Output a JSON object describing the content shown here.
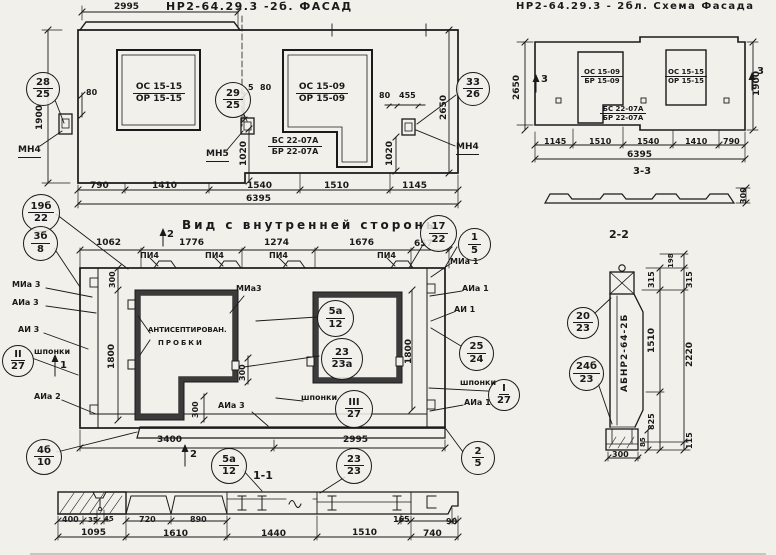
{
  "colors": {
    "paper": "#f2f0ea",
    "ink": "#1a1a1a"
  },
  "facade": {
    "title": "НР2-64.29.3 -2б. ФАСАД",
    "d2995": "2995",
    "win1": {
      "top": "ОС 15-15",
      "bot": "ОР 15-15"
    },
    "win2": {
      "top": "ОС 15-09",
      "bot": "ОР 15-09"
    },
    "sill": {
      "top": "БС 22-07А",
      "bot": "БР 22-07А"
    },
    "d80a": "80",
    "d5": "5",
    "d80b": "80",
    "d80c": "80",
    "d455": "455",
    "v1900": "1900",
    "v2650": "2650",
    "v1020a": "1020",
    "v1020b": "1020",
    "mn4l": "МН4",
    "mn5": "МН5",
    "mn4r": "МН4",
    "dims": [
      "790",
      "1410",
      "1540",
      "1510",
      "1145"
    ],
    "total": "6395",
    "c28": {
      "top": "28",
      "bot": "25"
    },
    "c29": {
      "top": "29",
      "bot": "25"
    },
    "c33": {
      "top": "33",
      "bot": "26"
    }
  },
  "schema": {
    "title": "НР2-64.29.3 - 2бл. Схема Фасада",
    "win1": {
      "top": "ОС 15-09",
      "bot": "БР 15-09"
    },
    "win2": {
      "top": "ОС 15-15",
      "bot": "ОР 15-15"
    },
    "sill": {
      "top": "БС 22-07А",
      "bot": "БР 22-07А"
    },
    "dims": [
      "1145",
      "1510",
      "1540",
      "1410",
      "790"
    ],
    "total": "6395",
    "v2650": "2650",
    "v1900": "1900",
    "m3a": "3",
    "m3b": "3"
  },
  "sec33": {
    "title": "3-3",
    "d300": "300"
  },
  "interior": {
    "title": "Вид с внутренней стороны",
    "dims_top": [
      "1062",
      "1776",
      "1274",
      "1676",
      "657"
    ],
    "pi4": "ПИ4",
    "d3400": "3400",
    "d2995": "2995",
    "v300a": "300",
    "v1800l": "1800",
    "v1800r": "1800",
    "v300b": "300",
    "v300c": "300",
    "m1": "1",
    "m2a": "2",
    "m2b": "2",
    "lbl": {
      "mia3": "МИа 3",
      "aia3": "АИа 3",
      "ai3": "АИ 3",
      "shponki": "шпонки",
      "aia2": "АИа 2",
      "mia1": "МИа 1",
      "aia1": "АИа 1",
      "ai1": "АИ 1",
      "aia1b": "АИа 1",
      "mia3i": "МИа3",
      "anti1": "АНТИСЕПТИРОВАН.",
      "anti2": "ПРОБКИ",
      "shponki2": "шпонки",
      "shponki3": "шпонки",
      "aia3i": "АИа 3"
    },
    "callouts": {
      "c19": {
        "top": "19б",
        "bot": "22"
      },
      "c3": {
        "top": "3б",
        "bot": "8"
      },
      "cII": {
        "top": "II",
        "bot": "27"
      },
      "c4": {
        "top": "4б",
        "bot": "10"
      },
      "c17": {
        "top": "17",
        "bot": "22"
      },
      "c1": {
        "top": "1",
        "bot": "5"
      },
      "c25": {
        "top": "25",
        "bot": "24"
      },
      "cI": {
        "top": "I",
        "bot": "27"
      },
      "c2": {
        "top": "2",
        "bot": "5"
      },
      "c5a": {
        "top": "5а",
        "bot": "12"
      },
      "c23a": {
        "top": "23",
        "bot": "23а"
      },
      "cIII": {
        "top": "III",
        "bot": "27"
      }
    }
  },
  "sec11": {
    "title": "1-1",
    "dims1": [
      "400",
      "35",
      "45",
      "720",
      "890",
      "165",
      "90"
    ],
    "dims2": [
      "1095",
      "1610",
      "1440",
      "1510",
      "740"
    ],
    "c5a": {
      "top": "5а",
      "bot": "12"
    },
    "c23": {
      "top": "23",
      "bot": "23"
    }
  },
  "sec22": {
    "title": "2-2",
    "body": "АБНР2-64-2Б",
    "d198": "198",
    "d315a": "315",
    "d315b": "315",
    "d1510": "1510",
    "d2220": "2220",
    "d825": "825",
    "d115": "115",
    "d85": "85",
    "d300": "300",
    "c20": {
      "top": "20",
      "bot": "23"
    },
    "c24": {
      "top": "24б",
      "bot": "23"
    }
  }
}
